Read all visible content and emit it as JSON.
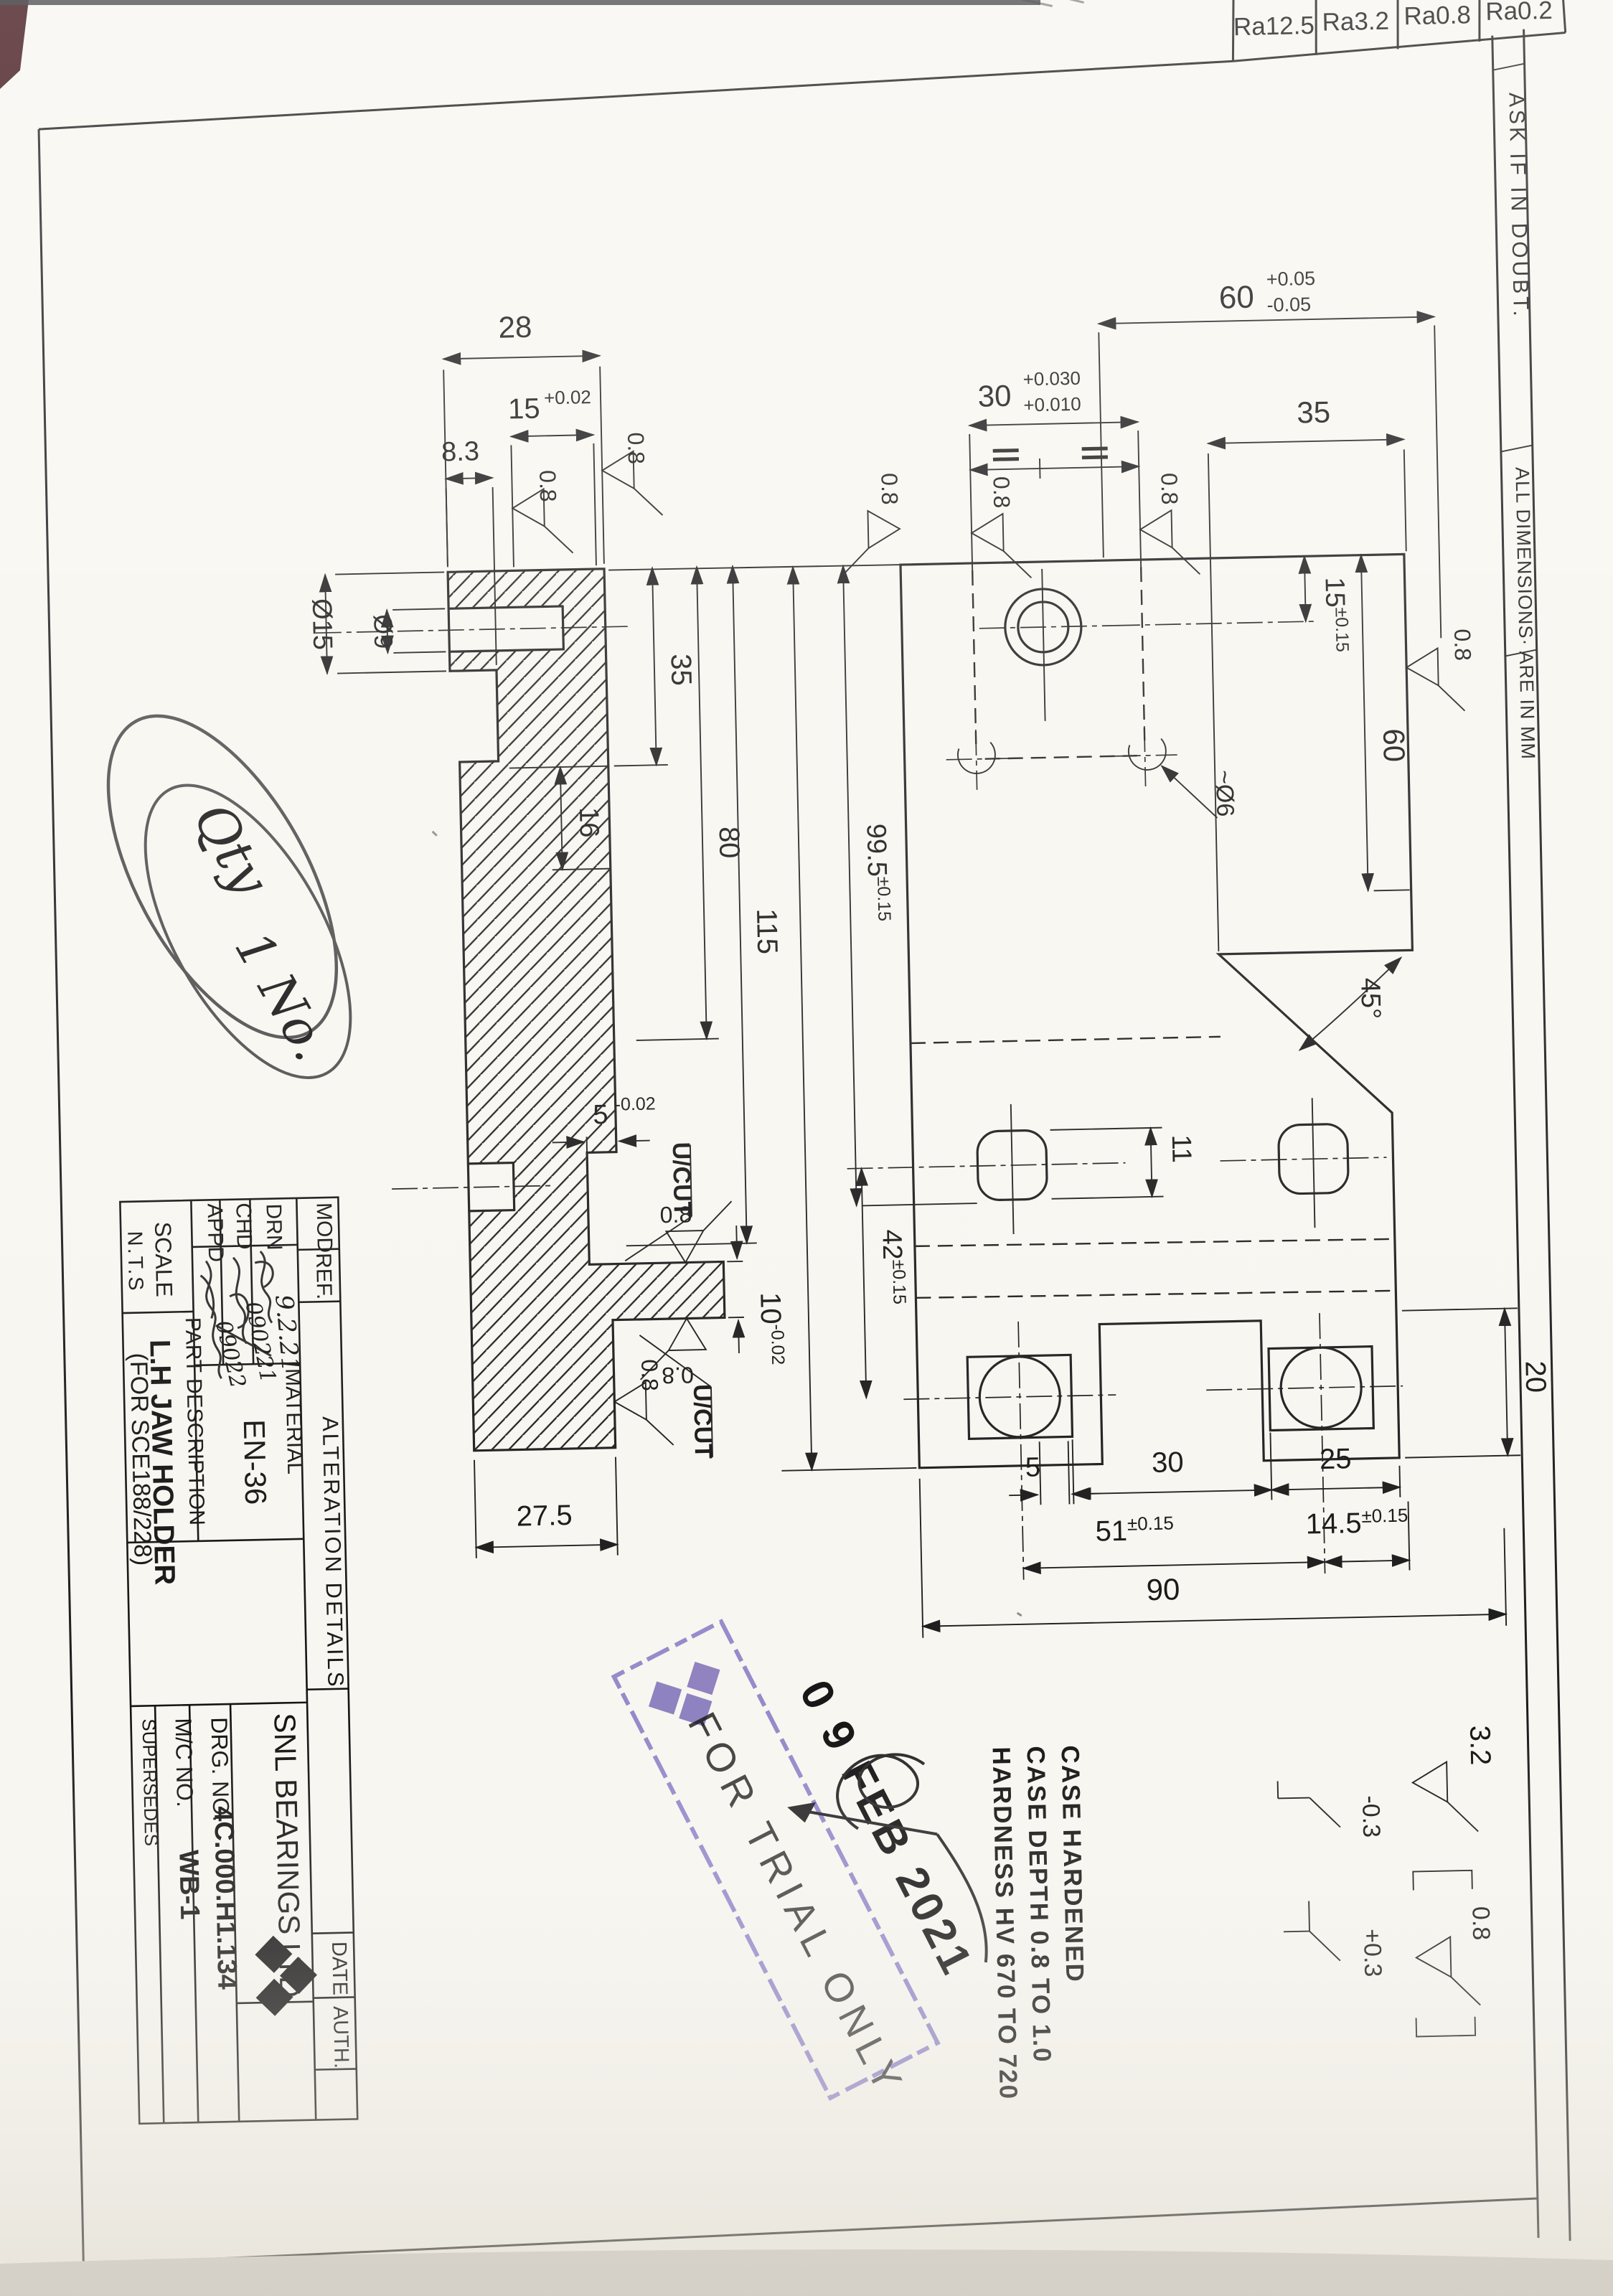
{
  "ra": {
    "c1": "Ra12.5",
    "c2": "Ra3.2",
    "c3": "Ra0.8",
    "c4": "Ra0.2"
  },
  "margin": {
    "ask": "ASK IF IN DOUBT.",
    "dims": "ALL DIMENSIONS·  ARE IN MM"
  },
  "side": {
    "d28": "28",
    "d15": "15",
    "d15t": "+0.02",
    "d83": "8.3",
    "dia15": "Ø15",
    "dia9": "Ø9",
    "d35": "35",
    "d16": "16",
    "d80": "80",
    "d115": "115",
    "d152": "152",
    "d5": "5",
    "d5t": "-0.02",
    "d10": "10",
    "d10t": "-0.02",
    "d275": "27.5",
    "ucut1": "U/CUT",
    "ucut2": "U/CUT",
    "f1": "0.8",
    "f2": "0.8",
    "f3": "0.8",
    "f4": "0.8",
    "f5": "0.8"
  },
  "front": {
    "d60": "60",
    "d60p": "+0.05",
    "d60m": "-0.05",
    "d30": "30",
    "d30p": "+0.030",
    "d30m": "+0.010",
    "d35": "35",
    "d15": "15",
    "d15t": "±0.15",
    "d60v": "60",
    "d995": "99.5",
    "d995t": "±0.15",
    "d42": "42",
    "d42t": "±0.15",
    "d11": "11",
    "dia6": "~Ø6",
    "d45": "45°",
    "d20": "20",
    "d5": "5",
    "d30b": "30",
    "d25": "25",
    "d51": "51",
    "d51t": "±0.15",
    "d145": "14.5",
    "d145t": "±0.15",
    "d90": "90",
    "f1": "0.8",
    "f2": "0.8",
    "f3": "0.8",
    "f4": "0.8"
  },
  "notes": {
    "l1": "CASE HARDENED",
    "l2": "CASE DEPTH 0.8 TO 1.0",
    "l3": "HARDNESS HV 670 TO 720"
  },
  "legend": {
    "rough": "3.2",
    "fine": "0.8",
    "minus": "-0.3",
    "plus": "+0.3"
  },
  "tb": {
    "mod": "MOD.",
    "ref": "REF.",
    "alteration": "ALTERATION   DETAILS",
    "date": "DATE",
    "auth": "AUTH.",
    "drn": "DRN",
    "chd": "CHD",
    "appd": "APPD",
    "scale": "SCALE",
    "nts": "N.T.S",
    "part_desc": "PART  DESCRIPTION",
    "part_name": "L.H JAW HOLDER",
    "part_for": "(FOR SCE188/228)",
    "material": "MATERIAL",
    "material_val": "EN-36",
    "company": "SNL BEARINGS LTD.",
    "drg_label": "DRG. NO.",
    "drg_no": "4C.000.H1.134",
    "mc_label": "M/C NO.",
    "mc_no": "WB-1",
    "supersedes": "SUPERSEDES",
    "drn_date": "9.2.21",
    "chd_date": "090221",
    "appd_date": "09022"
  },
  "stamp": {
    "date": "0 9 FEB 2021",
    "text": "FOR TRIAL ONLY"
  },
  "hand": {
    "qty": "Qty",
    "qty2": "1 No."
  }
}
